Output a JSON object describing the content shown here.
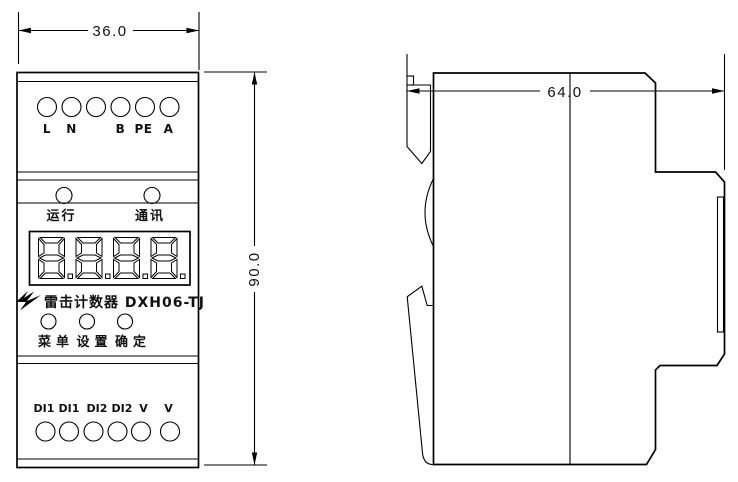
{
  "drawing": {
    "dims": {
      "width": "36.0",
      "height": "90.0",
      "depth": "64.0"
    },
    "front": {
      "terminals_top": [
        "L",
        "N",
        "B",
        "PE",
        "A"
      ],
      "leds": [
        "运行",
        "通讯"
      ],
      "display_value": "8.8.8.8.",
      "title": "雷击计数器 DXH06-TJ",
      "buttons": [
        "菜单",
        "设置",
        "确定"
      ],
      "terminals_bottom": [
        "DI1",
        "DI1",
        "DI2",
        "DI2",
        "V",
        "V"
      ]
    },
    "colors": {
      "line": "#000000",
      "background": "#ffffff"
    }
  }
}
